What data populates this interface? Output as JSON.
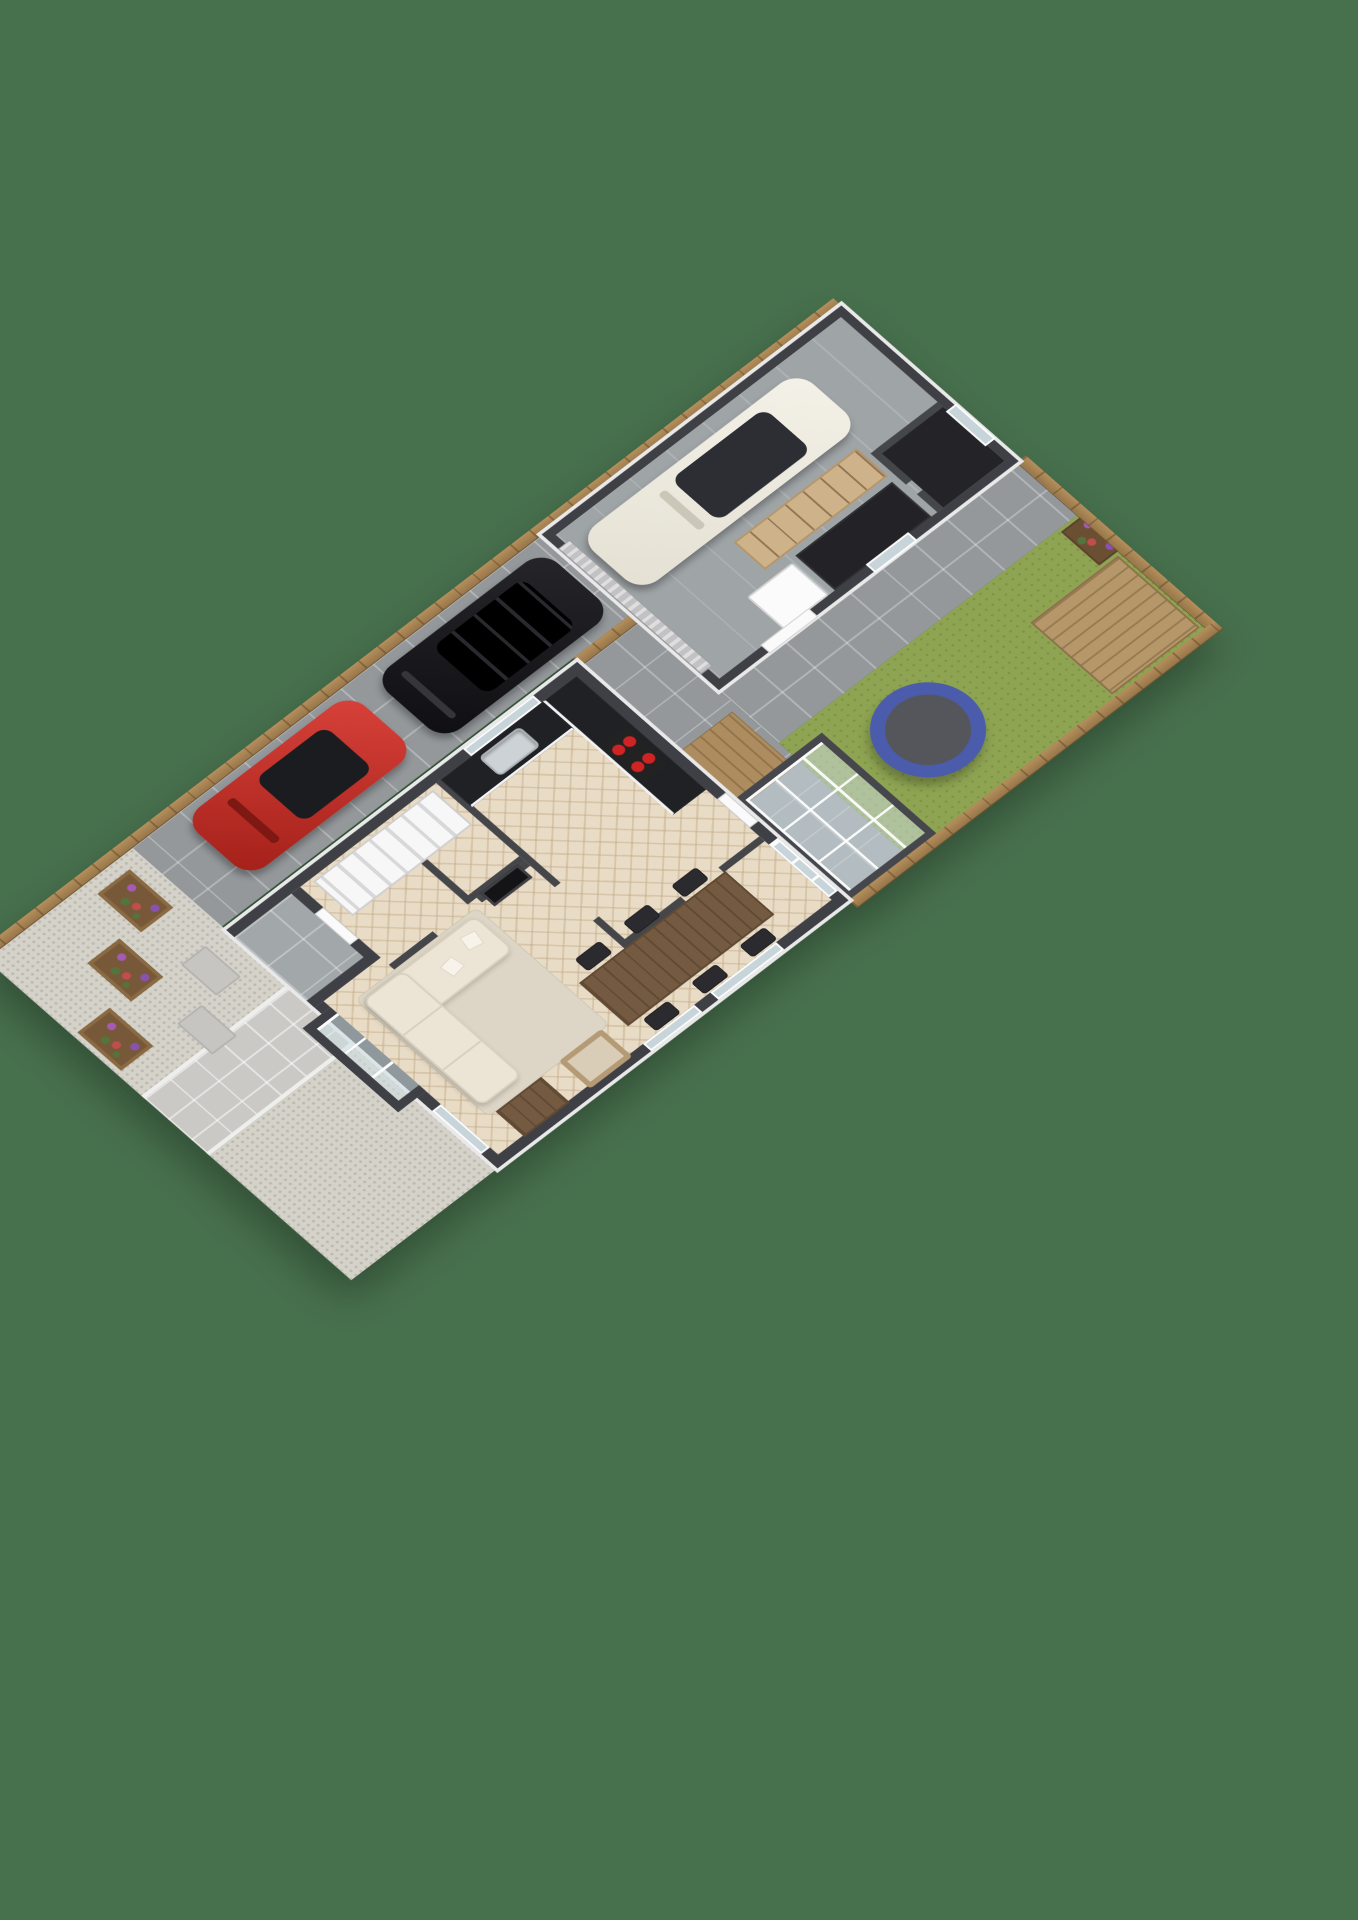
{
  "scene": {
    "type": "3d-floorplan-render",
    "view": "isometric-top-down",
    "background_color": "#47704d",
    "wall_top_color": "#3f4045",
    "wall_face_color": "#f2f2f2"
  },
  "outdoor": {
    "fences": [
      {
        "id": "left-fence",
        "material": "timber",
        "color": "#a9854f"
      },
      {
        "id": "back-fence",
        "material": "timber",
        "color": "#a9854f"
      },
      {
        "id": "right-fence",
        "material": "timber",
        "color": "#a9854f"
      },
      {
        "id": "side-gate",
        "material": "timber",
        "color": "#a9854f"
      }
    ],
    "zones": [
      {
        "id": "driveway",
        "surface": "concrete-pavers",
        "color": "#94989b"
      },
      {
        "id": "garage-side-path",
        "surface": "concrete-pavers",
        "color": "#94989b"
      },
      {
        "id": "rear-patio",
        "surface": "concrete-pavers",
        "color": "#94989b"
      },
      {
        "id": "lawn",
        "surface": "grass",
        "color": "#8ea452"
      },
      {
        "id": "deck",
        "surface": "timber-decking",
        "color": "#b5976a"
      },
      {
        "id": "timber-walkway",
        "surface": "timber-decking",
        "color": "#ad8c5f"
      },
      {
        "id": "front-gravel",
        "surface": "gravel",
        "color": "#d5d2ca"
      },
      {
        "id": "front-path",
        "surface": "paving",
        "color": "#cac9c5"
      },
      {
        "id": "porch",
        "surface": "paving",
        "color": "#a2a7aa"
      }
    ],
    "objects": [
      {
        "id": "trampoline",
        "ring_color": "#4a5cab",
        "mat_color": "#55565b"
      },
      {
        "id": "flower-bed",
        "flower_colors": [
          "#a55bb5",
          "#c14d4d"
        ]
      },
      {
        "id": "planter-1",
        "flower_colors": [
          "#a55bb5",
          "#c14d4d",
          "#53753c"
        ]
      },
      {
        "id": "planter-2",
        "flower_colors": [
          "#a55bb5",
          "#c14d4d",
          "#53753c"
        ]
      },
      {
        "id": "planter-3",
        "flower_colors": [
          "#a55bb5",
          "#c14d4d",
          "#53753c"
        ]
      },
      {
        "id": "stepping-stones",
        "count": 2
      }
    ]
  },
  "house": {
    "floor": "herringbone-oak",
    "rooms": [
      {
        "id": "kitchen"
      },
      {
        "id": "hallway"
      },
      {
        "id": "wc"
      },
      {
        "id": "living-room"
      },
      {
        "id": "dining-area"
      },
      {
        "id": "conservatory",
        "walls": "glass"
      }
    ],
    "kitchen": {
      "counter_top_color": "#202125",
      "cabinet_color": "#f4f4f4",
      "hob_burners": 4,
      "hob_burner_color": "#d02323",
      "sink": "stainless-steel"
    },
    "living": {
      "sofa_color": "#ece5d6",
      "rug_color": "#ddd6c6",
      "coffee_table_color": "#745a41",
      "armchair_frame_color": "#b59a76",
      "fireplace": true
    },
    "dining": {
      "table_color": "#745a41",
      "chair_count": 6,
      "chair_color": "#2b2b2f"
    },
    "features": [
      "staircase",
      "front-door",
      "bay-window",
      "sliding-glass-doors",
      "back-door",
      "kitchen-window"
    ]
  },
  "garage": {
    "objects": [
      {
        "id": "shelving-unit",
        "color": "#cdb28a"
      },
      {
        "id": "workbench",
        "color": "#232327"
      },
      {
        "id": "tall-cabinet",
        "color": "#fbfbfb"
      },
      {
        "id": "roller-door",
        "color": "#d6d6d6"
      },
      {
        "id": "storage-room"
      },
      {
        "id": "side-door"
      },
      {
        "id": "side-window"
      },
      {
        "id": "back-window"
      }
    ]
  },
  "vehicles": [
    {
      "id": "black-suv",
      "color": "#17171a",
      "location": "driveway"
    },
    {
      "id": "red-sports-car",
      "color": "#c33026",
      "location": "driveway"
    },
    {
      "id": "white-hatchback",
      "color": "#efece3",
      "location": "garage"
    }
  ]
}
